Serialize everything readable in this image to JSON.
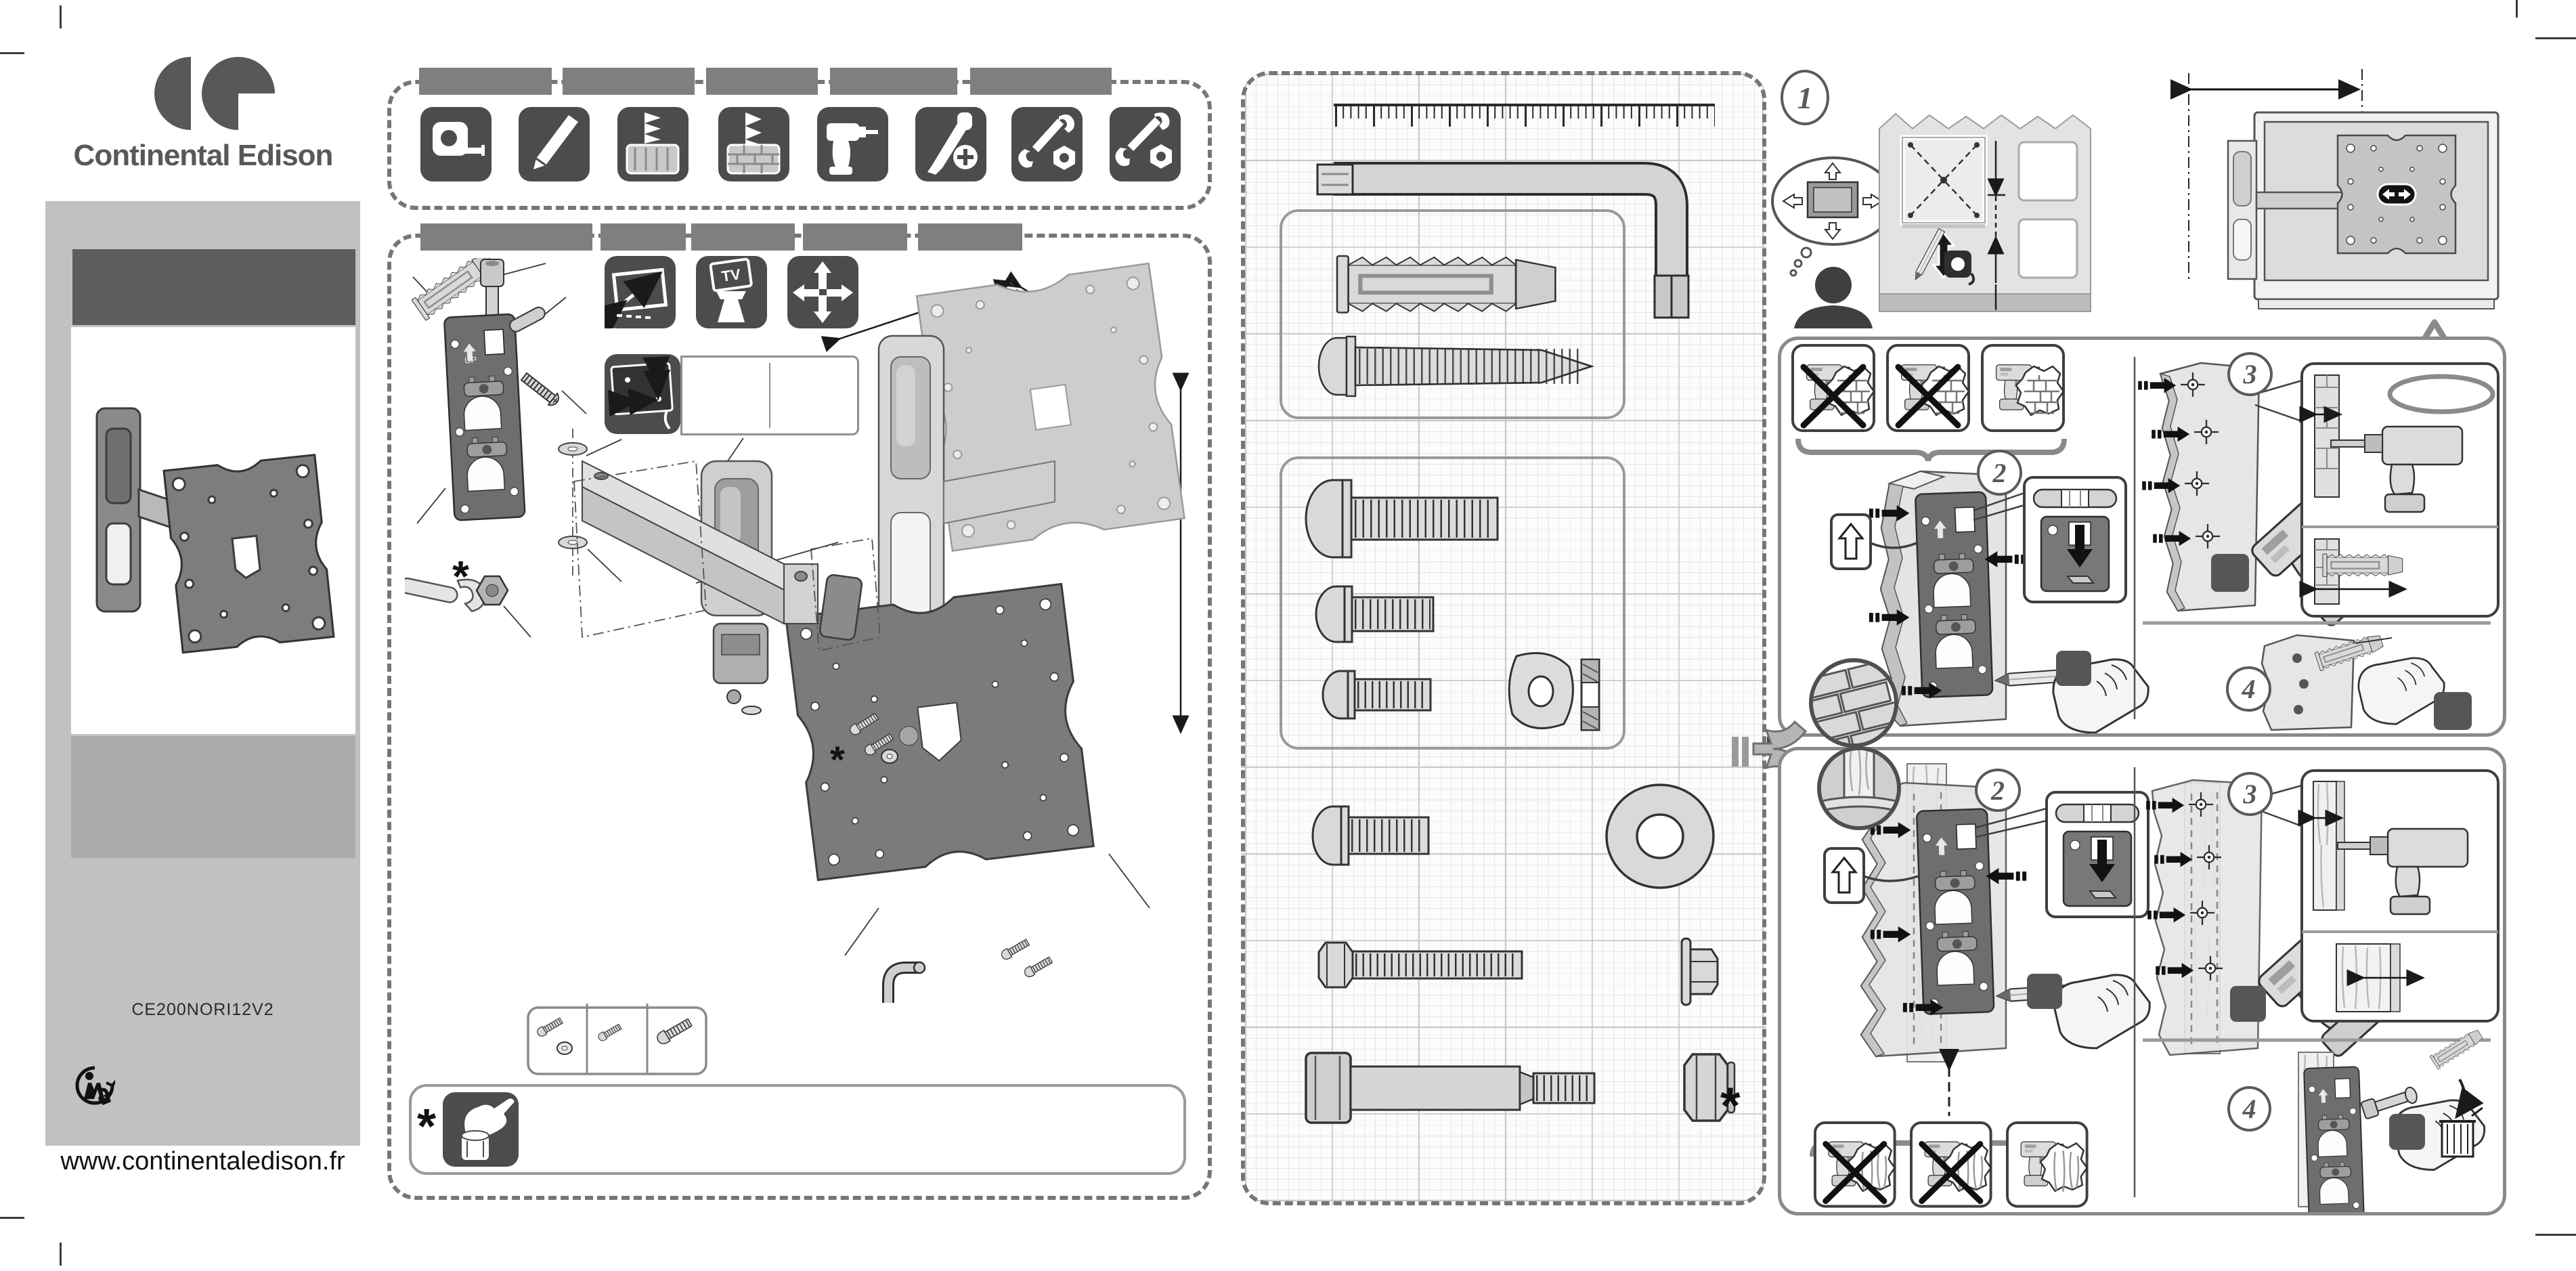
{
  "brand": {
    "name": "Continental Edison",
    "model": "CE200NORI12V2",
    "website": "www.continentaledison.fr"
  },
  "steps": {
    "one": "1",
    "two": "2",
    "three": "3",
    "four": "4"
  },
  "labels": {
    "up": "UP",
    "tv": "TV"
  },
  "symbols": {
    "asterisk": "*",
    "exclamation": "!"
  },
  "tools_panel": {
    "language_tab_count": 5,
    "tools": [
      "tape-measure",
      "pencil",
      "wood-drill-bit",
      "masonry-drill-bit",
      "power-drill",
      "phillips-screwdriver",
      "open-end-wrench",
      "box-wrench"
    ]
  },
  "assembly_panel": {
    "language_tab_count": 5,
    "spec_icons": [
      "screen-size-diagonal",
      "tv-weight",
      "swivel-motion"
    ],
    "vesa_icon": "vesa-hole-pattern",
    "screw_length_options": [
      "screw-with-washer",
      "short-screw",
      "long-screw"
    ],
    "note_icon": "hand-tighten"
  },
  "hardware_panel": {
    "items": [
      "ruler",
      "allen-key",
      "wall-anchor",
      "wood-screw",
      "bolt-long",
      "bolt-medium",
      "bolt-short",
      "washer-small",
      "bolt-m6",
      "washer-large",
      "hex-bolt",
      "flange-nut",
      "shoulder-bolt",
      "hex-nut"
    ]
  },
  "instructions": {
    "step1_icons": [
      "person-planning",
      "thought-bubble-tv",
      "wall-marking",
      "pencil",
      "tape-measure",
      "tv-rear-vesa"
    ],
    "wall_types": [
      "brick-concrete",
      "wood-stud"
    ],
    "warnings": [
      "no-drill-electric-wire",
      "no-drill-wall-edge",
      "drill-solid-area",
      "warning-triangle"
    ],
    "step_icons": [
      "spirit-level",
      "mark-holes-pencil",
      "drill-holes",
      "insert-anchor",
      "screw-bracket",
      "discard-anchor-trash"
    ]
  },
  "colors": {
    "tile_dark": "#4c4c4c",
    "bar_gray": "#7f7f7f",
    "panel_gray": "#c1c1c1",
    "band_dark": "#5e5e5e",
    "swatch_dark": "#565656",
    "plate_dark": "#7b7b7b",
    "metal_light": "#d9d9d9",
    "border_dash": "#767676"
  }
}
